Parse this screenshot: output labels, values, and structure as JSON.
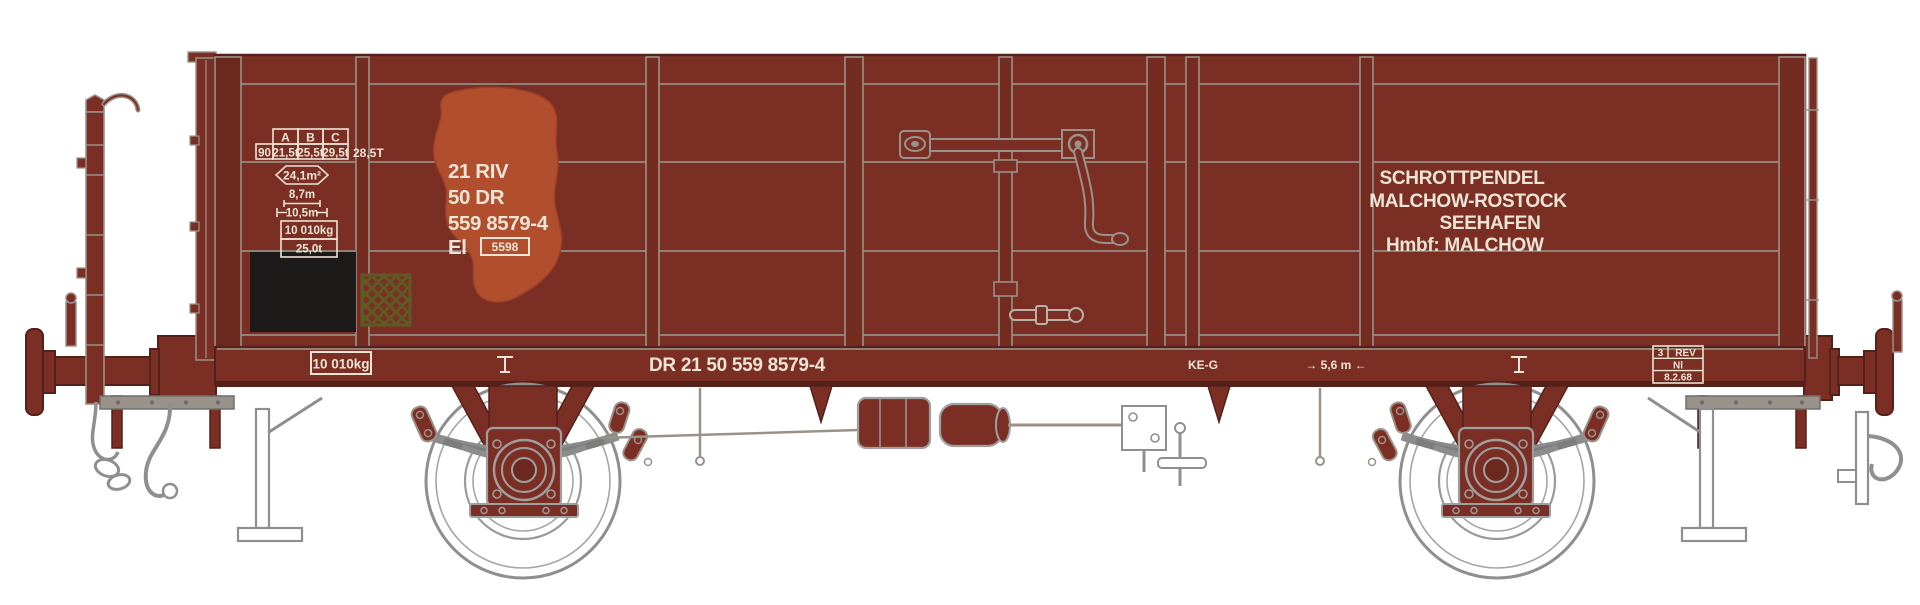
{
  "colors": {
    "body_brown": "#7b2f24",
    "body_shadow": "#54201a",
    "detail_line_gray": "#9a9288",
    "lettering_white": "#ece4d4",
    "rust_patch": "#b04e2e",
    "chalk_board_black": "#1b1a18",
    "hatch_olive": "#5f5a24",
    "metal_gray": "#8c8c8c",
    "wheel_white": "#ffffff",
    "background": "#ffffff"
  },
  "wagon": {
    "body_side": {
      "load_table": {
        "columns": [
          "A",
          "B",
          "C"
        ],
        "row": [
          "90",
          "21,5t",
          "25,5t",
          "29,5t"
        ],
        "side_value": "28,5T"
      },
      "dimensions": {
        "floor_area": "24,1m²",
        "inner_length": "8,7m",
        "overall_length": "10,5m",
        "tare_weight": "10 010kg",
        "load_limit": "25,0t"
      },
      "number_block": {
        "line1": "21 RIV",
        "line2": "50 DR",
        "line3": "559 8579-4",
        "class_letters": "El",
        "class_number_boxed": "5598"
      },
      "route_board": {
        "line1": "SCHROTTPENDEL",
        "line2": "MALCHOW-ROSTOCK",
        "line3": "SEEHAFEN",
        "home_label": "Hmbf:",
        "home_station": "MALCHOW"
      }
    },
    "solebar": {
      "tare_boxed": "10 010kg",
      "vehicle_number": "DR 21 50 559 8579-4",
      "brake_type": "KE-G",
      "axle_distance": "→ 5,6 m ←",
      "rev_box": {
        "cell1": "3",
        "cell2": "REV",
        "works": "Nl",
        "date": "8.2.68"
      }
    }
  }
}
